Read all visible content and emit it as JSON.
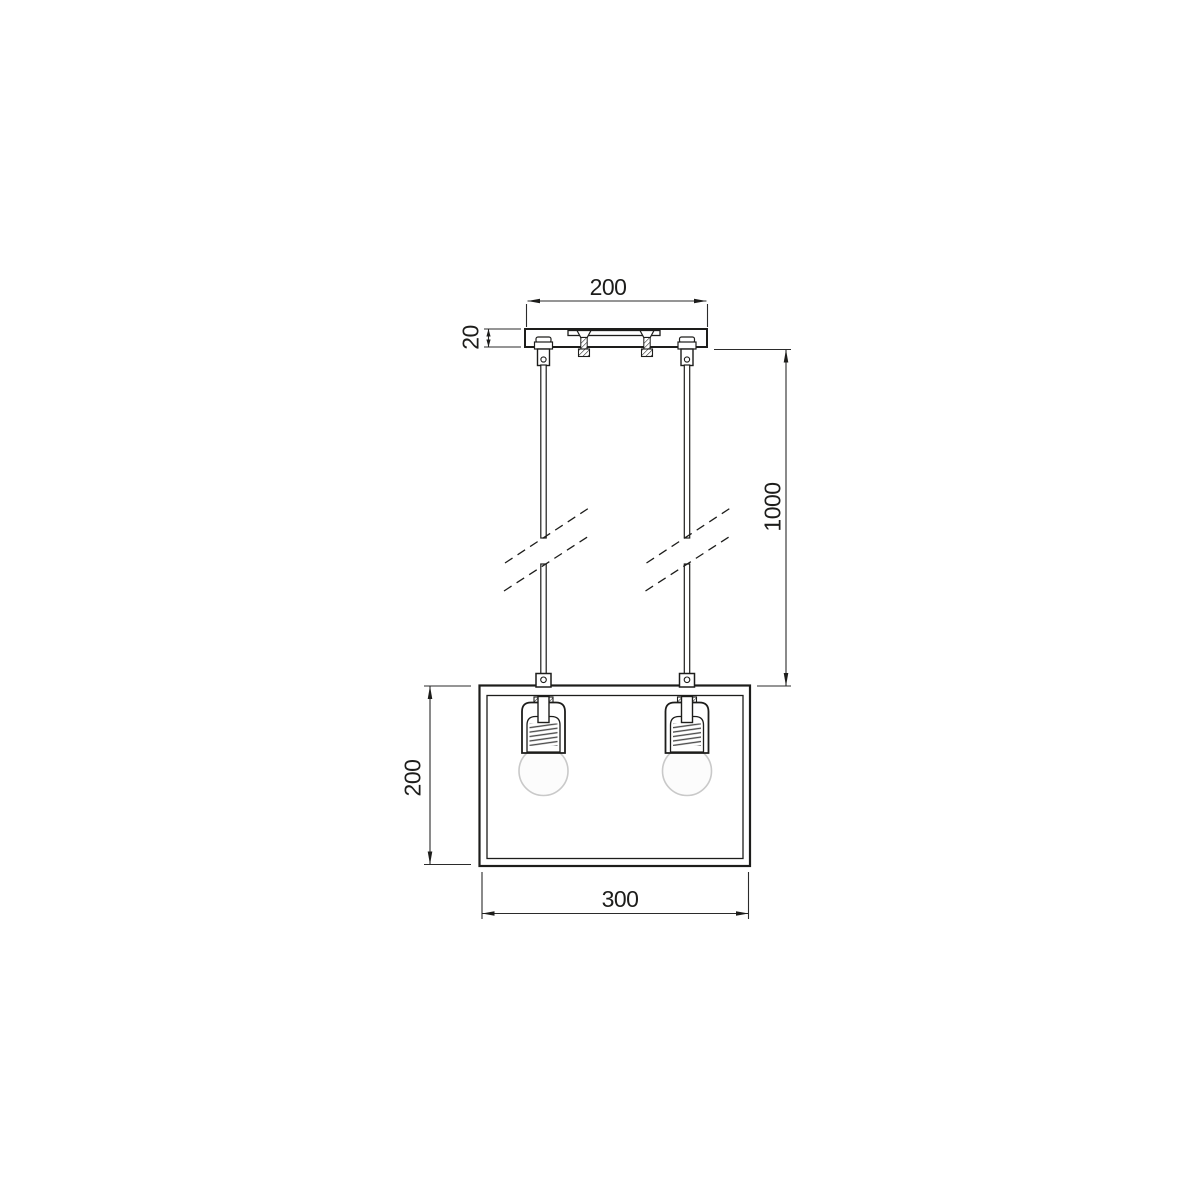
{
  "drawing": {
    "type": "technical-dimension-drawing",
    "subject": "two-light pendant lamp with ceiling canopy, twin suspension rods (break marks) and rectangular open-frame shade",
    "colors": {
      "line": "#1d1d1b",
      "dimension_line": "#2b2b2b",
      "bulb_outline": "#c9c9c9",
      "background": "#ffffff"
    },
    "dimensions": {
      "canopy_width": "200",
      "canopy_height": "20",
      "suspension_length": "1000",
      "shade_height": "200",
      "shade_width": "300"
    }
  }
}
